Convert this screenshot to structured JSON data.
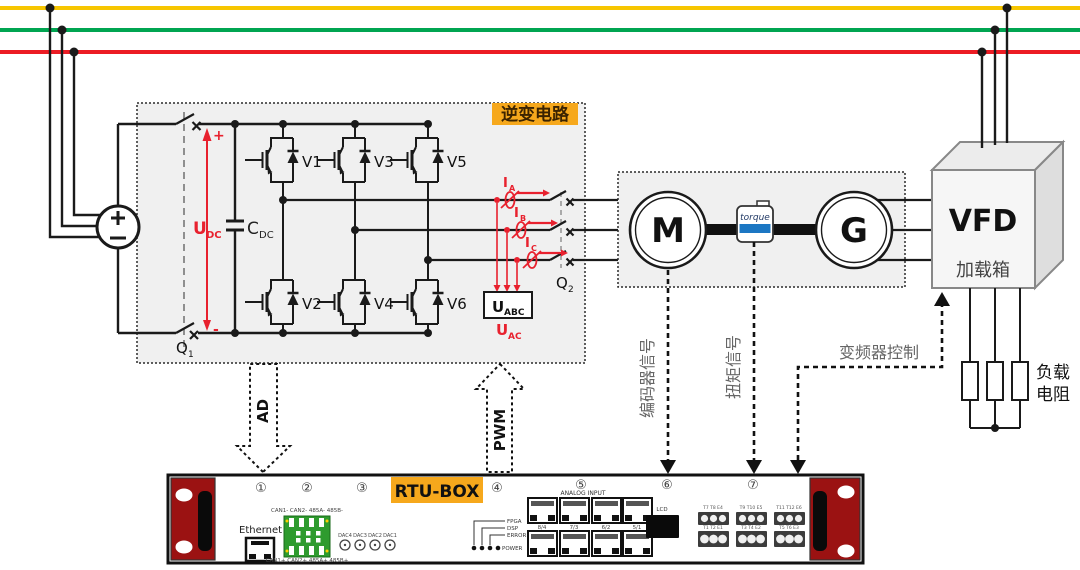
{
  "colors": {
    "bus_yellow": "#F7C600",
    "bus_green": "#00A551",
    "bus_red": "#EC1C24",
    "accent_label_bg": "#F6A81C",
    "rtu_ear_red": "#9B1212",
    "green_terminal": "#2E9B2E",
    "torque_blue": "#1C77C3",
    "signal_red": "#E8212E",
    "gray_text": "#666666"
  },
  "inverter": {
    "title": "逆变电路",
    "v1": "V1",
    "v2": "V2",
    "v3": "V3",
    "v4": "V4",
    "v5": "V5",
    "v6": "V6",
    "udc_main": "U",
    "udc_sub": "DC",
    "cdc_main": "C",
    "cdc_sub": "DC",
    "plus": "+",
    "minus": "-",
    "q1_main": "Q",
    "q1_sub": "1",
    "q2_main": "Q",
    "q2_sub": "2",
    "ia_main": "I",
    "ia_sub": "A",
    "ib_main": "I",
    "ib_sub": "B",
    "ic_main": "I",
    "ic_sub": "C",
    "uabc_main": "U",
    "uabc_sub": "ABC",
    "uac_main": "U",
    "uac_sub": "AC"
  },
  "drive": {
    "motor": "M",
    "generator": "G",
    "torque": "torque"
  },
  "vfd": {
    "title": "VFD",
    "subtitle": "加载箱"
  },
  "load": {
    "line1": "负载",
    "line2": "电阻"
  },
  "signals": {
    "ad": "AD",
    "pwm": "PWM",
    "encoder": "编码器信号",
    "torque": "扭矩信号",
    "vfd_control": "变频器控制"
  },
  "rtu": {
    "title": "RTU-BOX",
    "numbers": [
      "①",
      "②",
      "③",
      "④",
      "⑤",
      "⑥",
      "⑦"
    ],
    "ethernet": "Ethernet",
    "green_top": "CAN1- CAN2- 485A- 485B-",
    "green_bottom": "CAN1+ CAN2+ 485A+ 485B+",
    "dac_labels": [
      "DAC4",
      "DAC3",
      "DAC2",
      "DAC1"
    ],
    "led_labels": [
      "FPGA",
      "DSP",
      "ERROR",
      "POWER"
    ],
    "analog_input": "ANALOG INPUT",
    "rj45_labels": [
      "8/4",
      "7/3",
      "6/2",
      "5/1"
    ],
    "lcd": "LCD",
    "term_top": [
      "T7 T8 E4",
      "T9 T10 E5",
      "T11 T12 E6"
    ],
    "term_bottom": [
      "T1 T2 E1",
      "T3 T4 E2",
      "T5 T6 E3"
    ]
  }
}
